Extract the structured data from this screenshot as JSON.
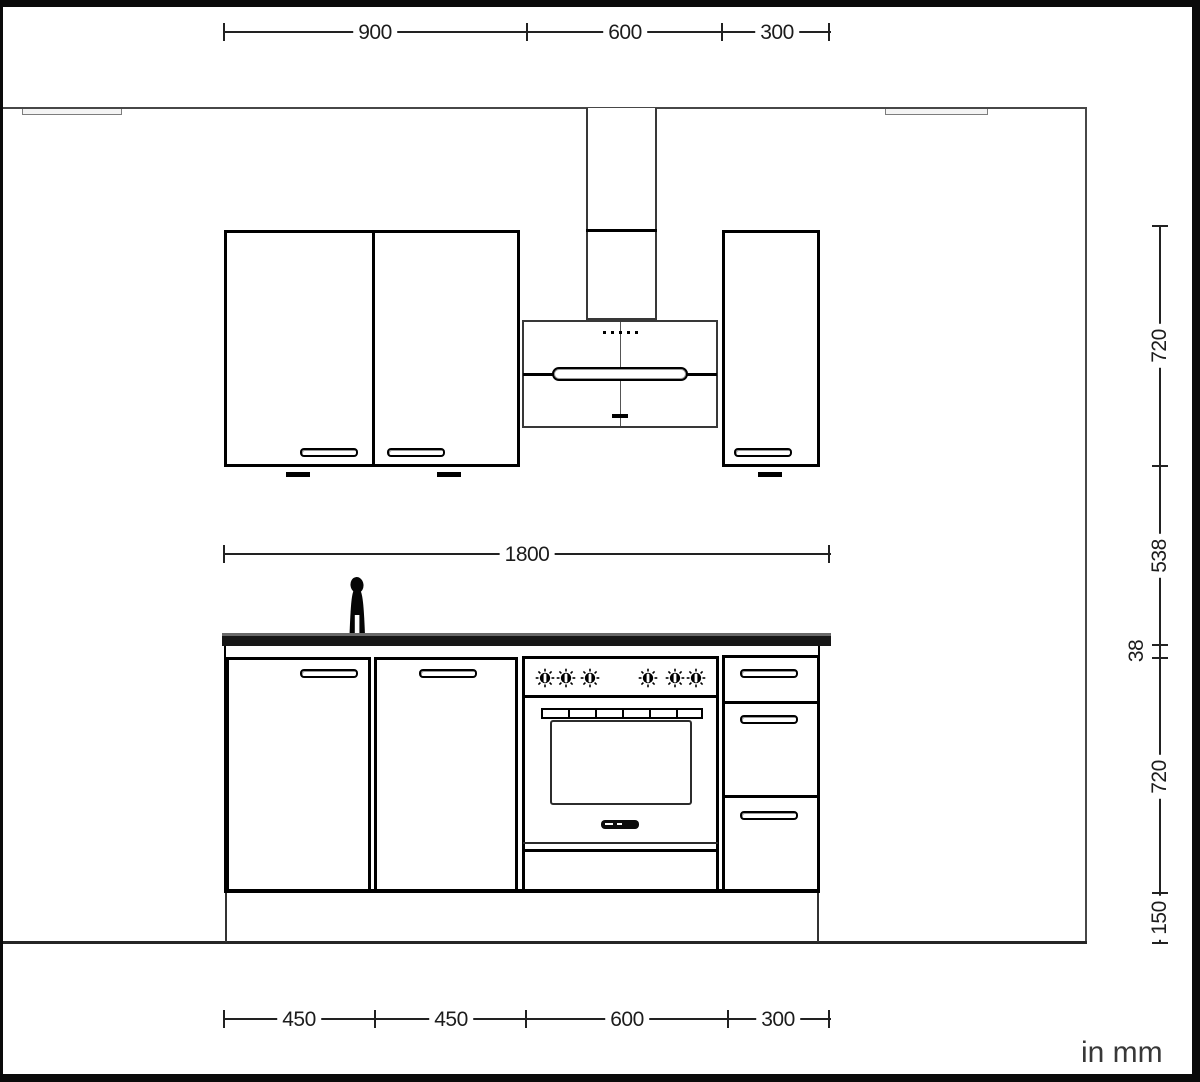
{
  "drawing": {
    "unit_label": "in mm",
    "dimensions": {
      "top": [
        "900",
        "600",
        "300"
      ],
      "middle": [
        "1800"
      ],
      "bottom": [
        "450",
        "450",
        "600",
        "300"
      ],
      "right": [
        "720",
        "538",
        "38",
        "720",
        "150"
      ]
    }
  }
}
